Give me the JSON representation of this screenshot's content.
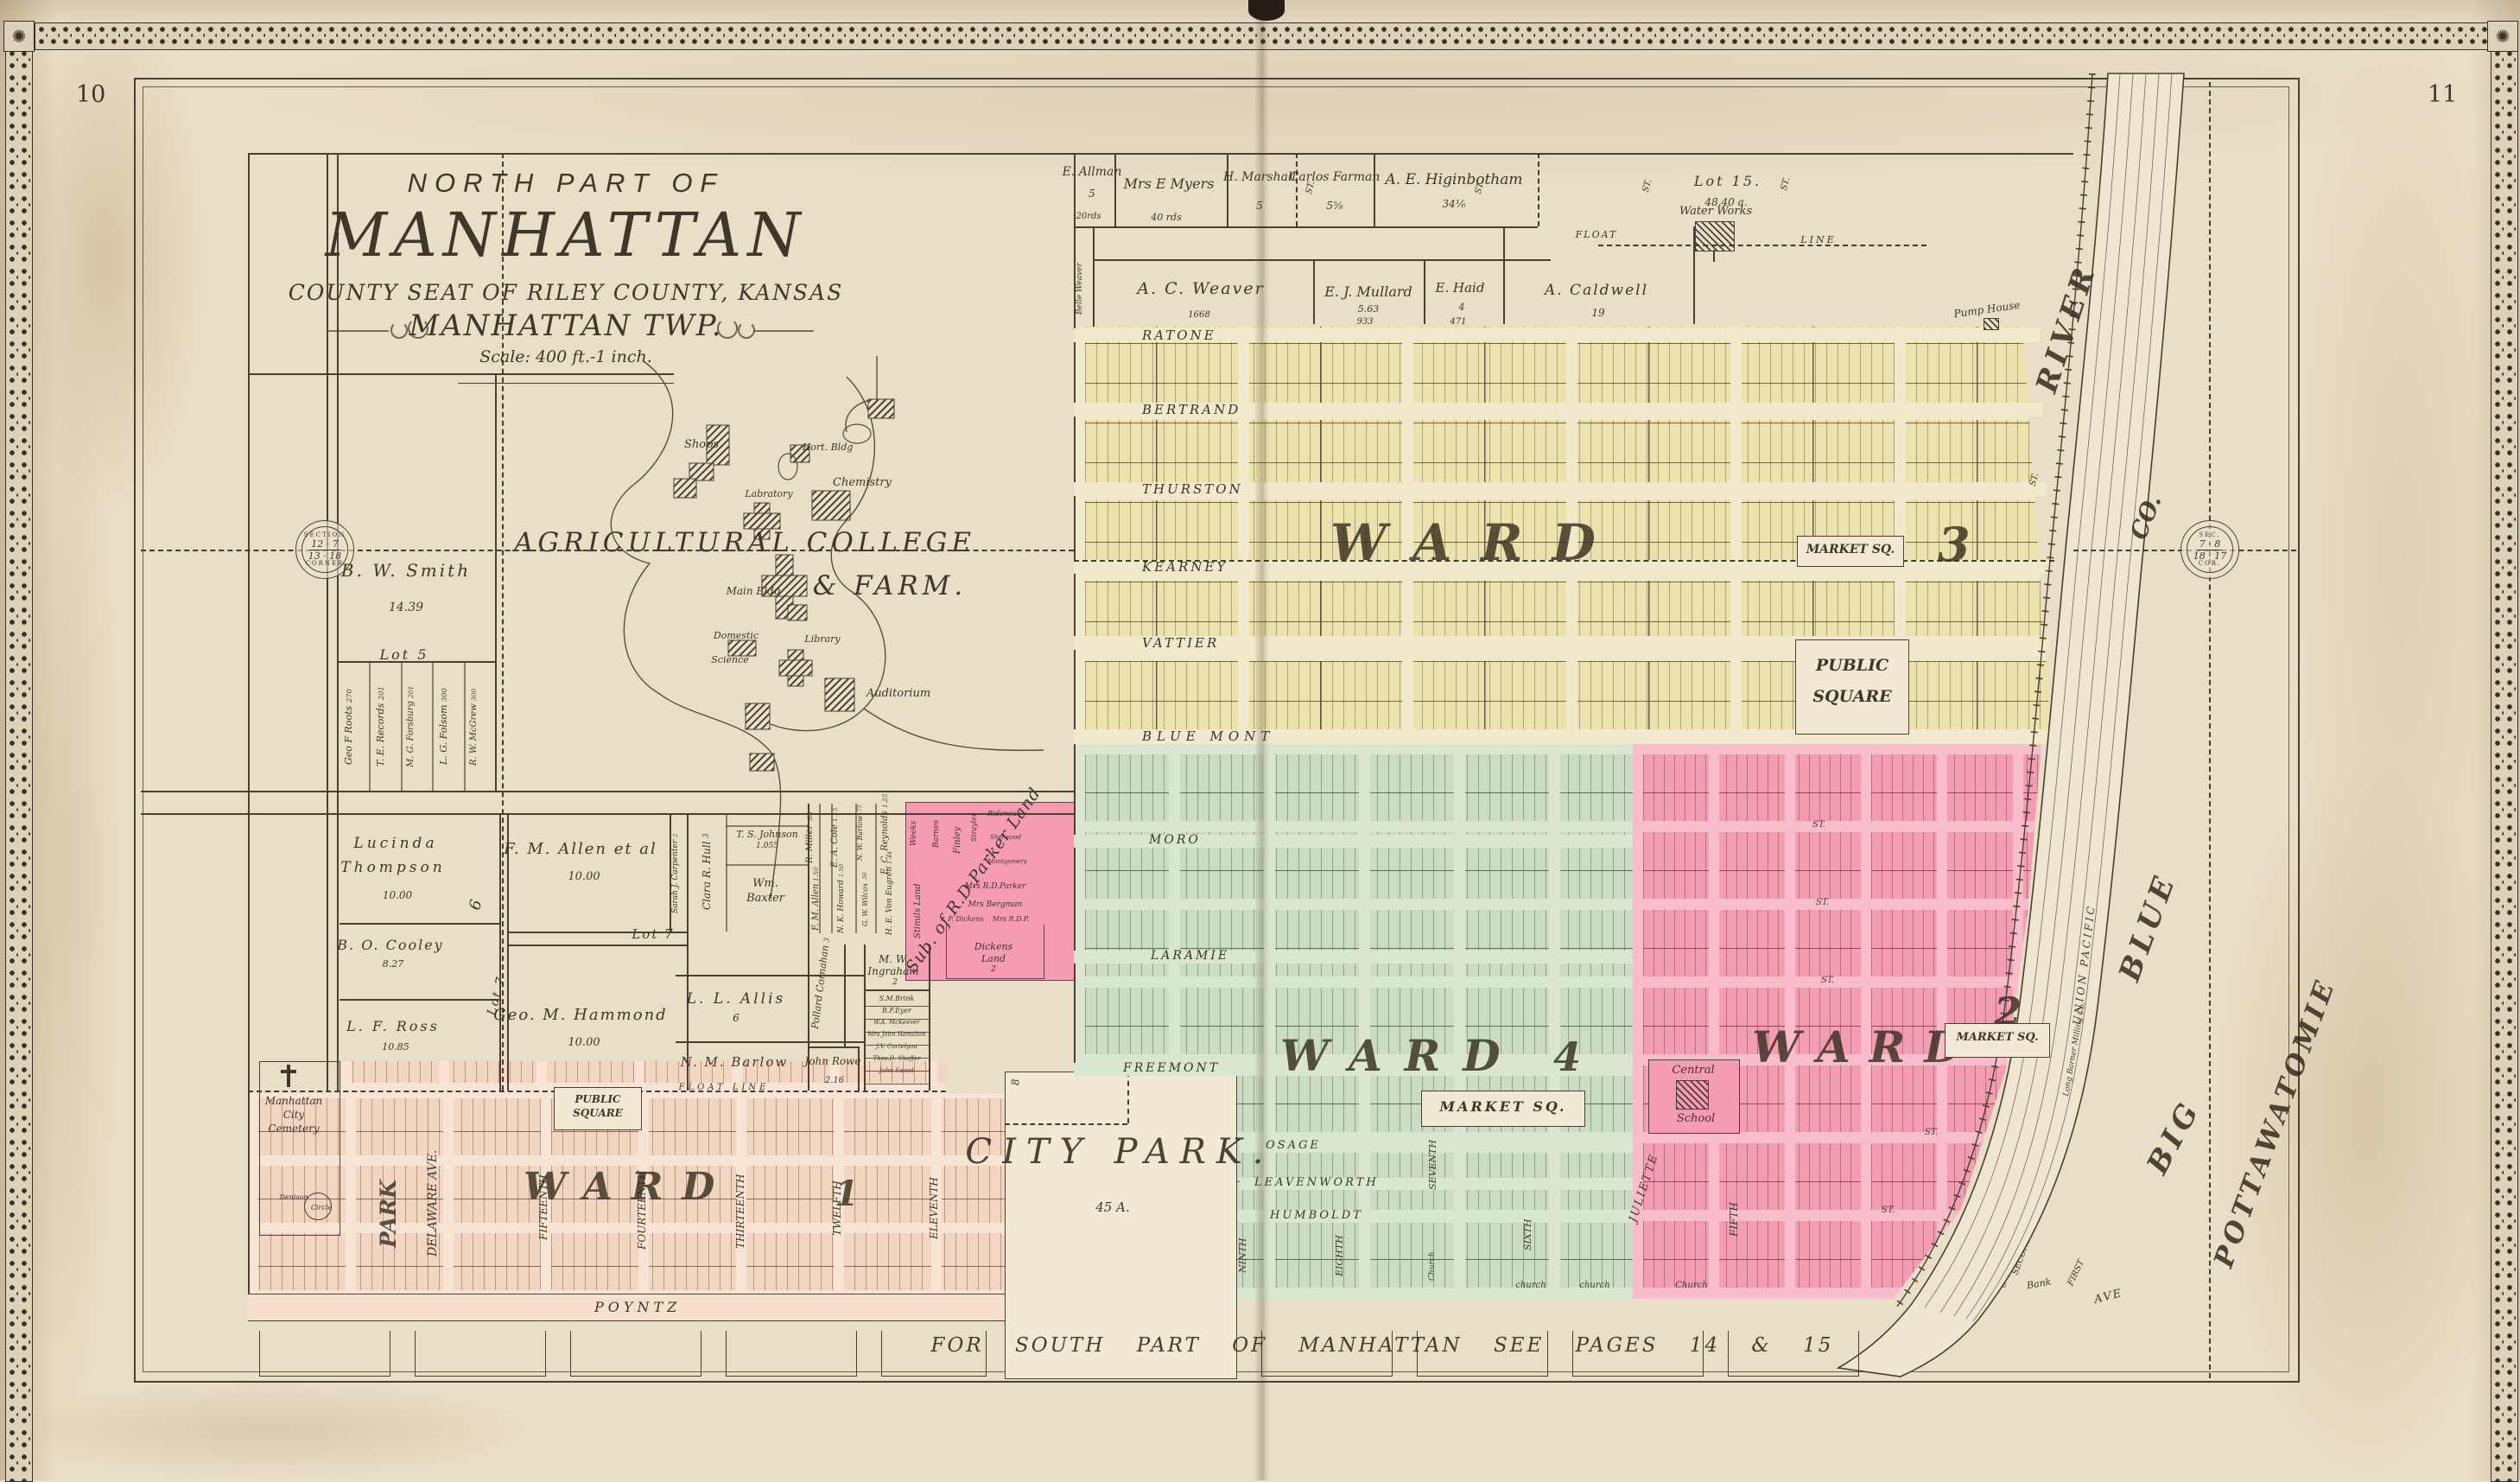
{
  "page": {
    "left_number": "10",
    "right_number": "11"
  },
  "title": {
    "l1": "NORTH PART OF",
    "l2": "MANHATTAN",
    "l3": "COUNTY SEAT OF RILEY COUNTY, KANSAS",
    "l4": "MANHATTAN TWP.",
    "scale": "Scale: 400 ft.-1 inch."
  },
  "bottom_note": "FOR SOUTH PART OF MANHATTAN SEE PAGES 14 & 15",
  "wards": {
    "w3": {
      "word": "WARD",
      "num": "3"
    },
    "w4": {
      "word": "WARD",
      "num": "4"
    },
    "w2": {
      "word": "WARD",
      "num": "2"
    },
    "w1": {
      "word": "WARD",
      "num": "1"
    }
  },
  "squares": {
    "public1": "PUBLIC",
    "public2": "SQUARE",
    "market": "MARKET SQ."
  },
  "streets": {
    "ward3": [
      "RATONE",
      "BERTRAND",
      "THURSTON",
      "KEARNEY",
      "VATTIER",
      "BLUE MONT"
    ],
    "ward4": [
      "MORO",
      "LARAMIE",
      "FREEMONT",
      "OSAGE",
      "LEAVENWORTH",
      "HUMBOLDT"
    ],
    "ward1_vertical": [
      "PARK",
      "DELAWARE AVE.",
      "FIFTEENTH",
      "FOURTEENTH",
      "THIRTEENTH",
      "TWELFTH",
      "ELEVENTH"
    ],
    "ward4_vertical": [
      "NINTH",
      "EIGHTH",
      "SEVENTH",
      "SIXTH",
      "JULIETTE"
    ],
    "ward2_vertical": [
      "FIFTH",
      "SECOND",
      "FIRST"
    ],
    "poyntz": "POYNTZ",
    "bank": "Bank",
    "ave": "AVE",
    "st": "ST."
  },
  "top_farms": {
    "allman": {
      "name": "E. Allman",
      "acres": "5",
      "note": "20rds"
    },
    "myers": {
      "name": "Mrs E Myers",
      "note": "40 rds"
    },
    "marshall": {
      "name": "H. Marshall",
      "acres": "5"
    },
    "farman": {
      "name": "Carlos Farman",
      "acres": "5⅝"
    },
    "higinbotham": {
      "name": "A. E. Higinbotham",
      "acres": "34⅙"
    },
    "lot15": {
      "name": "Lot 15.",
      "acres": "48.40 a."
    },
    "float": "FLOAT",
    "line": "LINE"
  },
  "row2": {
    "belle": "Belle Weaver",
    "weaver": {
      "name": "A. C. Weaver",
      "num": "1668"
    },
    "mullard": {
      "name": "E. J. Mullard",
      "acres": "5.63",
      "num": "933"
    },
    "haid": {
      "name": "E. Haid",
      "acres": "4",
      "num": "471"
    },
    "caldwell": {
      "name": "A. Caldwell",
      "acres": "19"
    },
    "water_works": "Water Works",
    "pump_house": "Pump House"
  },
  "west": {
    "smith": {
      "name": "B. W. Smith",
      "acres": "14.39"
    },
    "lot5": "Lot 5",
    "lot6": "6",
    "lot7": "Lot 7",
    "strip": [
      {
        "name": "Geo F Roots",
        "acres": "270"
      },
      {
        "name": "T. E. Records",
        "acres": "201"
      },
      {
        "name": "M. G. Forsburg",
        "acres": "201"
      },
      {
        "name": "L. G. Folsom",
        "acres": "300"
      },
      {
        "name": "R. W. McGrew",
        "acres": "300"
      }
    ],
    "thompson": {
      "n1": "Lucinda",
      "n2": "Thompson",
      "acres": "10.00"
    },
    "cooley": {
      "name": "B. O. Cooley",
      "acres": "8.27"
    },
    "ross": {
      "name": "L. F. Ross",
      "acres": "10.85"
    },
    "cemetery": {
      "l1": "Manhattan",
      "l2": "City",
      "l3": "Cemetery"
    },
    "denison": {
      "l1": "Denison",
      "l2": "Circle"
    }
  },
  "middle": {
    "allen_etal": {
      "name": "F. M. Allen et al",
      "acres": "10.00"
    },
    "carpenter": {
      "name": "Sarah J. Carpenter",
      "acres": "2"
    },
    "hammond": {
      "name": "Geo. M. Hammond",
      "acres": "10.00"
    },
    "hull": {
      "name": "Clara R. Hull",
      "acres": "3"
    },
    "johnson": {
      "name": "T. S. Johnson",
      "acres": "1.055"
    },
    "baxter": {
      "n1": "Wm.",
      "n2": "Baxter"
    },
    "miller": {
      "name": "R. Miller",
      "acres": ".85"
    },
    "cole": {
      "name": "E. A. Cole",
      "acres": "1.15"
    },
    "nw_barlow": {
      "name": "N. W. Barlow",
      "acres": ".75"
    },
    "fm_allen": {
      "name": "F. M. Allen",
      "acres": "1.50"
    },
    "howard": {
      "name": "N. K. Howard",
      "acres": "1.50"
    },
    "wilcox": {
      "name": "G. W. Wilcox",
      "acres": ".56"
    },
    "reynolds": {
      "name": "E. C. Reynolds",
      "acres": "1.25"
    },
    "von_eugren": {
      "name": "H. E. Von Eugren",
      "acres": "1.44"
    },
    "allis": {
      "name": "L. L. Allis",
      "acres": "6"
    },
    "nm_barlow": "N. M. Barlow",
    "cornahan": {
      "name": "Pollard Cornahan",
      "acres": "3"
    },
    "rowe": {
      "name": "John Rowe",
      "acres": "2.16"
    },
    "ingraham": {
      "n1": "M. W.",
      "n2": "Ingraham",
      "acres": "2"
    },
    "slivers": [
      "S.M.Brink",
      "B.F.Eyer",
      "W.A. McKeever",
      "Mrs John Hamilton",
      "J.V. Cortelyou",
      "Thos.D. Shaffer",
      "John Sweet"
    ],
    "float_line": "FLOAT LINE"
  },
  "parker": {
    "sub_title": "Sub. of R.D.Parker Land",
    "weeks": "Weeks",
    "barnes": "Barnes",
    "finley": "Finley",
    "strayler": "Strayler",
    "ridenour": "Ridenour",
    "sherwood": "Sherwood",
    "montgomery": "Montgomery",
    "mrs_parker": "Mrs R.D.Parker",
    "bergman": "Mrs Bergman",
    "dickens": "P. Dickens",
    "rdp": "Mrs R.D.P.",
    "dickens_land": {
      "n1": "Dickens",
      "n2": "Land",
      "acres": "2"
    },
    "stimils": "Stimils Land"
  },
  "college": {
    "name": "AGRICULTURAL COLLEGE",
    "name2": "& FARM.",
    "shops": "Shops",
    "hort": "Hort. Bldg",
    "chemistry": "Chemistry",
    "labratory": "Labratory",
    "main": "Main Bldg",
    "domestic1": "Domestic",
    "domestic2": "Science",
    "library": "Library",
    "auditorium": "Auditorium"
  },
  "park": {
    "name": "CITY PARK.",
    "acres": "45 A.",
    "num": "8"
  },
  "school": {
    "l1": "Central",
    "l2": "School"
  },
  "church": "Church",
  "church_lc": "church",
  "river": {
    "big": "BIG",
    "blue": "BLUE",
    "river": "RIVER",
    "county": "POTTAWATOMIE",
    "co": "CO.",
    "railroad": "UNION PACIFIC",
    "milling": "Long Barner Milling Co.",
    "city_hall": "City Hall"
  },
  "seals": {
    "left": {
      "arc_top": "SECTION",
      "arc_bottom": "CORNER",
      "r1": "12 · 7",
      "r2": "13 · 18"
    },
    "right": {
      "arc_top": "SEC.",
      "arc_bottom": "COR.",
      "r1": "7 · 8",
      "r2": "18 · 17"
    }
  }
}
